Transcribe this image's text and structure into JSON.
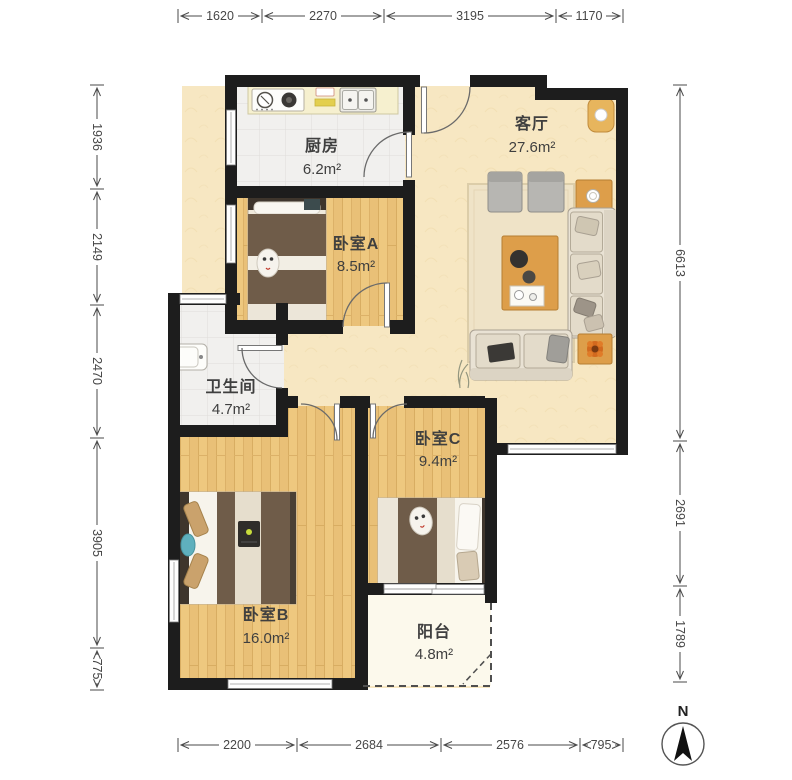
{
  "plan": {
    "rooms": [
      {
        "id": "kitchen",
        "name": "厨房",
        "area": "6.2m²"
      },
      {
        "id": "living",
        "name": "客厅",
        "area": "27.6m²"
      },
      {
        "id": "bedroomA",
        "name": "卧室A",
        "area": "8.5m²"
      },
      {
        "id": "bathroom",
        "name": "卫生间",
        "area": "4.7m²"
      },
      {
        "id": "bedroomC",
        "name": "卧室C",
        "area": "9.4m²"
      },
      {
        "id": "bedroomB",
        "name": "卧室B",
        "area": "16.0m²"
      },
      {
        "id": "balcony",
        "name": "阳台",
        "area": "4.8m²"
      }
    ],
    "dimensions": {
      "top": [
        "1620",
        "2270",
        "3195",
        "1170"
      ],
      "left": [
        "1936",
        "2149",
        "2470",
        "3905",
        "775"
      ],
      "right": [
        "6613",
        "2691",
        "1789"
      ],
      "bottom": [
        "2200",
        "2684",
        "2576",
        "795"
      ]
    },
    "compass": {
      "label": "N"
    },
    "colors": {
      "wall": "#1d1d1d",
      "wood_floor": "#eec87f",
      "living_floor": "#f7e7c2",
      "tile_floor": "#f1f0ee",
      "balcony_floor": "#fcf9ec",
      "wood_furniture": "#dd9e4a",
      "blanket": "#6f5c49",
      "dimension_text": "#474747"
    }
  }
}
